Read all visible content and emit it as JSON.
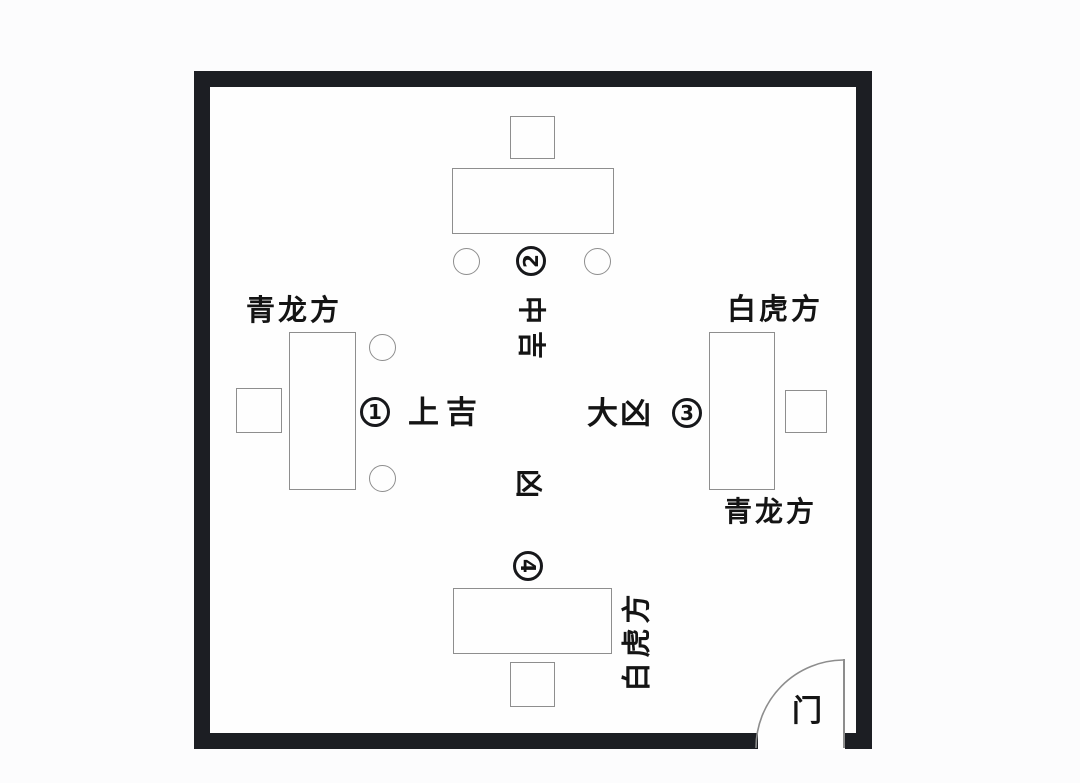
{
  "door": {
    "label": "门"
  },
  "markers": {
    "m1": "1",
    "m2": "2",
    "m3": "3",
    "m4": "4"
  },
  "luck": {
    "p1": "上吉",
    "p2": "中吉",
    "p3": "大凶",
    "p4": "凶"
  },
  "directions": {
    "left_desk_top": "青龙方",
    "right_desk_top": "白虎方",
    "right_desk_bottom": "青龙方",
    "bottom_desk_side": "白虎方"
  },
  "colors": {
    "wall": "#1c1e23",
    "furniture_outline": "#8e8e8e",
    "text": "#141414",
    "background": "#fcfcfd"
  }
}
